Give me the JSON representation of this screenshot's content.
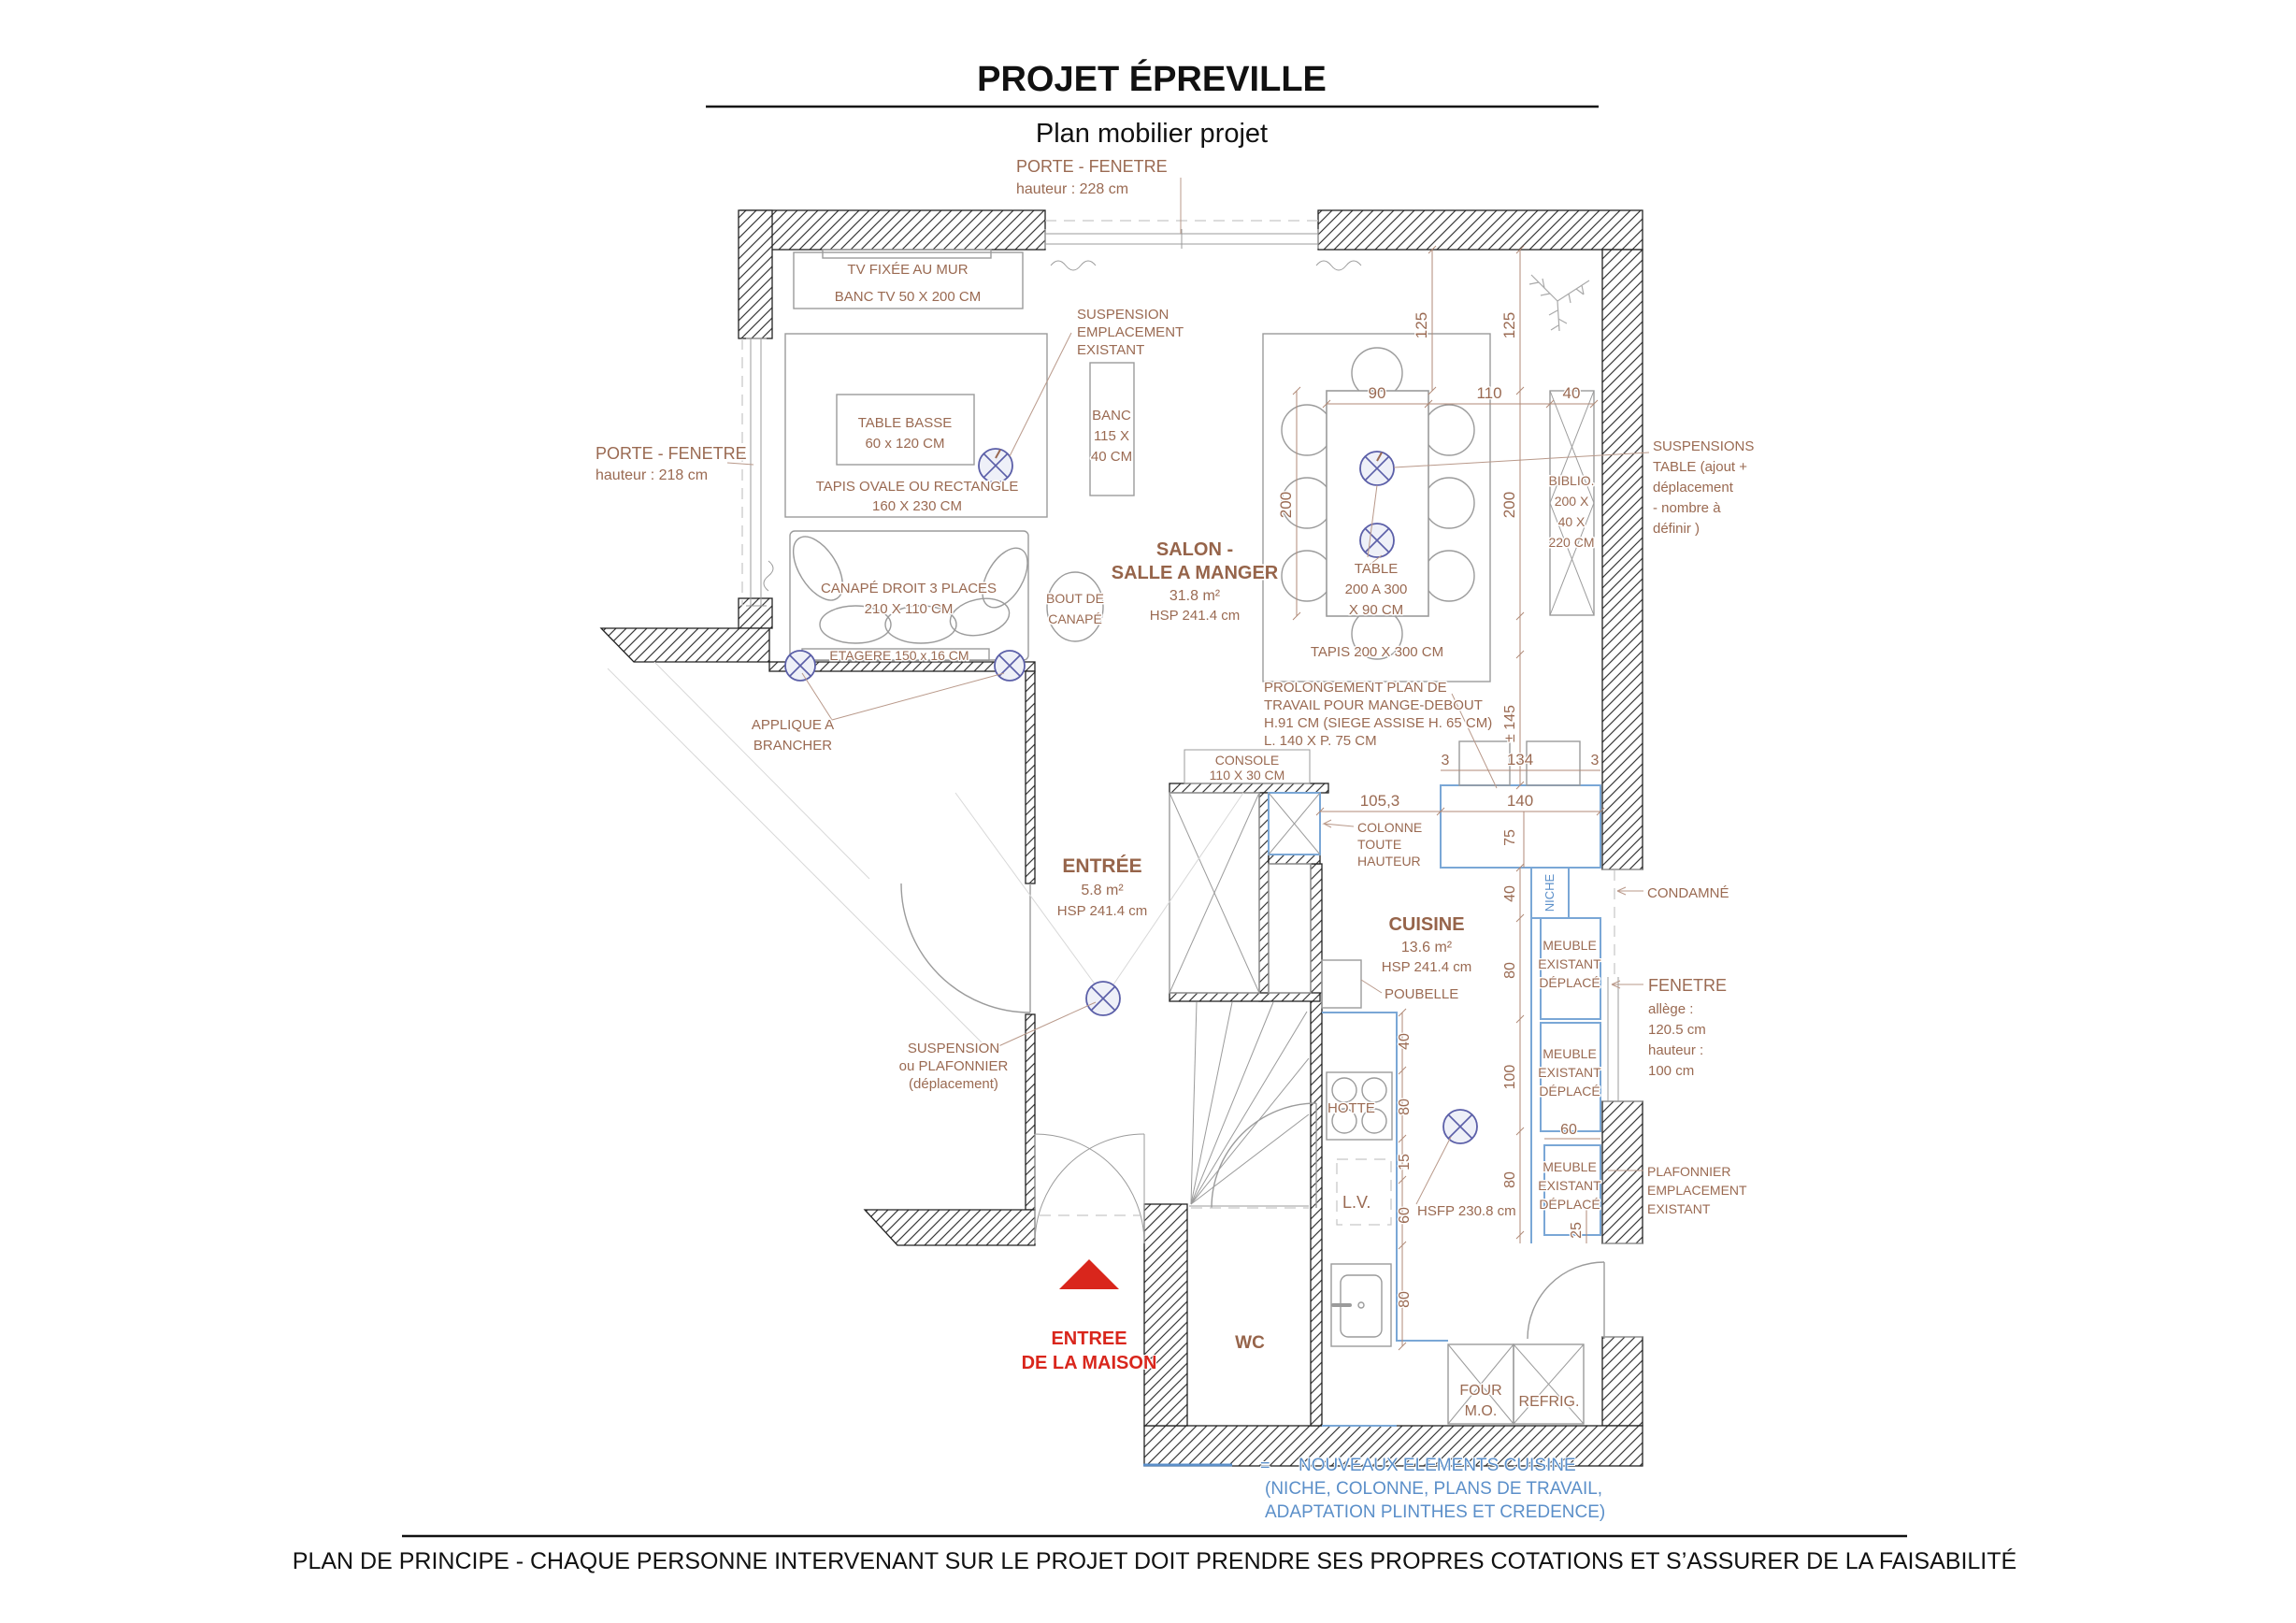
{
  "header": {
    "title": "PROJET ÉPREVILLE",
    "subtitle": "Plan mobilier projet"
  },
  "footer": {
    "text": "PLAN DE PRINCIPE - CHAQUE PERSONNE INTERVENANT SUR LE PROJET DOIT PRENDRE SES PROPRES COTATIONS ET S’ASSURER DE LA FAISABILITÉ"
  },
  "legend": {
    "eq": "=",
    "line1": "NOUVEAUX ELEMENTS CUISINE",
    "line2": "(NICHE, COLONNE, PLANS DE TRAVAIL,",
    "line3": "ADAPTATION PLINTHES ET CREDENCE)"
  },
  "rooms": {
    "salon": {
      "l1": "SALON -",
      "l2": "SALLE A MANGER",
      "area": "31.8 m²",
      "hsp": "HSP 241.4 cm"
    },
    "entree": {
      "l1": "ENTRÉE",
      "area": "5.8 m²",
      "hsp": "HSP 241.4 cm"
    },
    "cuisine": {
      "l1": "CUISINE",
      "area": "13.6 m²",
      "hsp": "HSP 241.4 cm"
    },
    "wc": {
      "l1": "WC"
    }
  },
  "annotations": {
    "porte_fenetre_top": {
      "l1": "PORTE - FENETRE",
      "l2": "hauteur : 228 cm"
    },
    "porte_fenetre_left": {
      "l1": "PORTE - FENETRE",
      "l2": "hauteur : 218 cm"
    },
    "tv": "TV FIXÉE AU MUR",
    "banc_tv": "BANC TV 50 X 200 CM",
    "suspension_salon": {
      "l1": "SUSPENSION",
      "l2": "EMPLACEMENT",
      "l3": "EXISTANT"
    },
    "table_basse": {
      "l1": "TABLE BASSE",
      "l2": "60 x 120 CM"
    },
    "tapis_salon": {
      "l1": "TAPIS OVALE  OU RECTANGLE",
      "l2": "160 X 230 CM"
    },
    "banc": {
      "l1": "BANC",
      "l2": "115 X",
      "l3": "40 CM"
    },
    "canape": {
      "l1": "CANAPÉ DROIT 3 PLACES",
      "l2": "210 X 110 CM"
    },
    "etagere": "ETAGERE 150 x 16 CM",
    "bout_canape": {
      "l1": "BOUT DE",
      "l2": "CANAPÉ"
    },
    "applique": {
      "l1": "APPLIQUE A",
      "l2": "BRANCHER"
    },
    "table_sam": {
      "l1": "TABLE",
      "l2": "200 A 300",
      "l3": "X 90 CM"
    },
    "tapis_sam": "TAPIS  200 X 300 CM",
    "biblio": {
      "l1": "BIBLIO.",
      "l2": "200 X",
      "l3": "40 X",
      "l4": "220 CM"
    },
    "suspensions_table": {
      "l1": "SUSPENSIONS",
      "l2": "TABLE (ajout  +",
      "l3": "déplacement",
      "l4": "- nombre à",
      "l5": "définir )"
    },
    "prolongement": {
      "l1": "PROLONGEMENT PLAN DE",
      "l2": "TRAVAIL POUR MANGE-DEBOUT",
      "l3": "H.91 CM (SIEGE ASSISE H. 65 CM)",
      "l4": "L. 140 X P. 75 CM"
    },
    "console": {
      "l1": "CONSOLE",
      "l2": "110 X 30 CM"
    },
    "colonne": {
      "l1": "COLONNE",
      "l2": "TOUTE",
      "l3": "HAUTEUR"
    },
    "suspension_entree": {
      "l1": "SUSPENSION",
      "l2": "ou PLAFONNIER",
      "l3": "(déplacement)"
    },
    "poubelle": "POUBELLE",
    "hotte": "HOTTE",
    "lv": "L.V.",
    "hsfp": "HSFP 230.8 cm",
    "niche": "NICHE",
    "meuble": {
      "l1": "MEUBLE",
      "l2": "EXISTANT",
      "l3": "DÉPLACÉ"
    },
    "condamne": "CONDAMNÉ",
    "fenetre": {
      "l1": "FENETRE",
      "l2": "allège :",
      "l3": "120.5 cm",
      "l4": "hauteur :",
      "l5": "100 cm"
    },
    "plafonnier": {
      "l1": "PLAFONNIER",
      "l2": "EMPLACEMENT",
      "l3": "EXISTANT"
    },
    "four": {
      "l1": "FOUR",
      "l2": "M.O."
    },
    "refrig": "REFRIG.",
    "entree_maison": {
      "l1": "ENTREE",
      "l2": "DE LA MAISON"
    }
  },
  "dims": {
    "d125a": "125",
    "d125b": "125",
    "d90": "90",
    "d110": "110",
    "d40top": "40",
    "d200a": "200",
    "d200b": "200",
    "d145": "± 145",
    "d3a": "3",
    "d134": "134",
    "d3b": "3",
    "d1053": "105,3",
    "d140": "140",
    "d75": "75",
    "d40r": "40",
    "d80r1": "80",
    "d100r": "100",
    "d80r2": "80",
    "d60m": "60",
    "d25": "25",
    "d40l": "40",
    "d80l1": "80",
    "d15l": "15",
    "d60l": "60",
    "d80l2": "80"
  },
  "colors": {
    "label_brown": "#9a6a52",
    "accent_blue": "#5b8fc9",
    "element_blue": "#7aa7d6",
    "light_indigo": "#5b5fa8",
    "red": "#d9261c",
    "wall_black": "#1a1a1a",
    "furniture_gray": "#9b9b9b"
  }
}
